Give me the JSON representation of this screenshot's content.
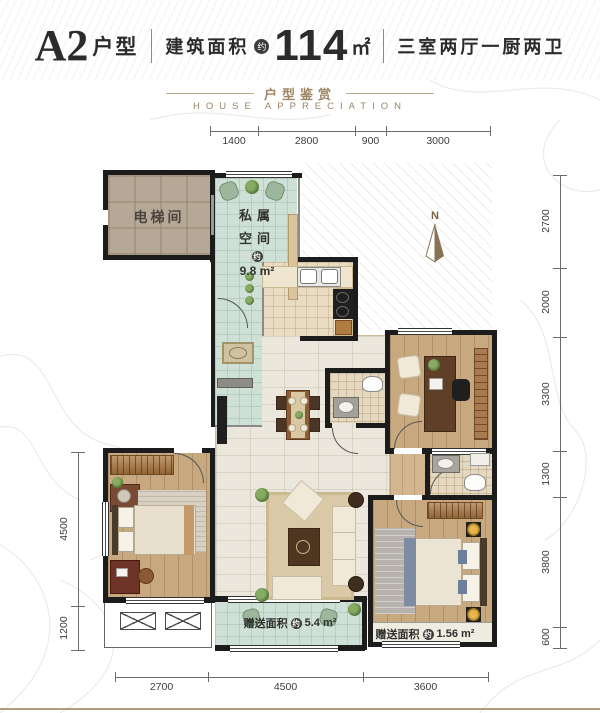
{
  "header": {
    "unit": "A2",
    "unit_suffix": "户型",
    "area_label": "建筑面积",
    "approx": "约",
    "area_value": "114",
    "area_unit": "㎡",
    "rooms_desc": "三室两厅一厨两卫",
    "subtitle_cn": "户型鉴赏",
    "subtitle_en": "HOUSE APPRECIATION"
  },
  "compass": {
    "north": "N"
  },
  "rooms": {
    "elevator": "电梯间",
    "private": {
      "line1": "私属",
      "line2": "空间",
      "approx": "约",
      "area": "9.8 m²"
    },
    "gift_balcony": {
      "label": "赠送面积",
      "approx": "约",
      "value": "5.4 m²"
    },
    "gift_bay": {
      "label": "赠送面积",
      "approx": "约",
      "value": "1.56 m²"
    }
  },
  "dims": {
    "top": [
      "1400",
      "2800",
      "900",
      "3000"
    ],
    "right": [
      "2700",
      "2000",
      "3300",
      "1300",
      "3800",
      "600"
    ],
    "left": [
      "4500",
      "1200"
    ],
    "bottom": [
      "2700",
      "4500",
      "3600"
    ]
  },
  "colors": {
    "accent_brown": "#9d8565",
    "wall_black": "#1c1c1c",
    "tile_teal": "#cfe1d7",
    "tile_beige": "#e9dcc2",
    "floor_wood": "#c7a87f",
    "bottom_rule": "#b59b7e"
  }
}
